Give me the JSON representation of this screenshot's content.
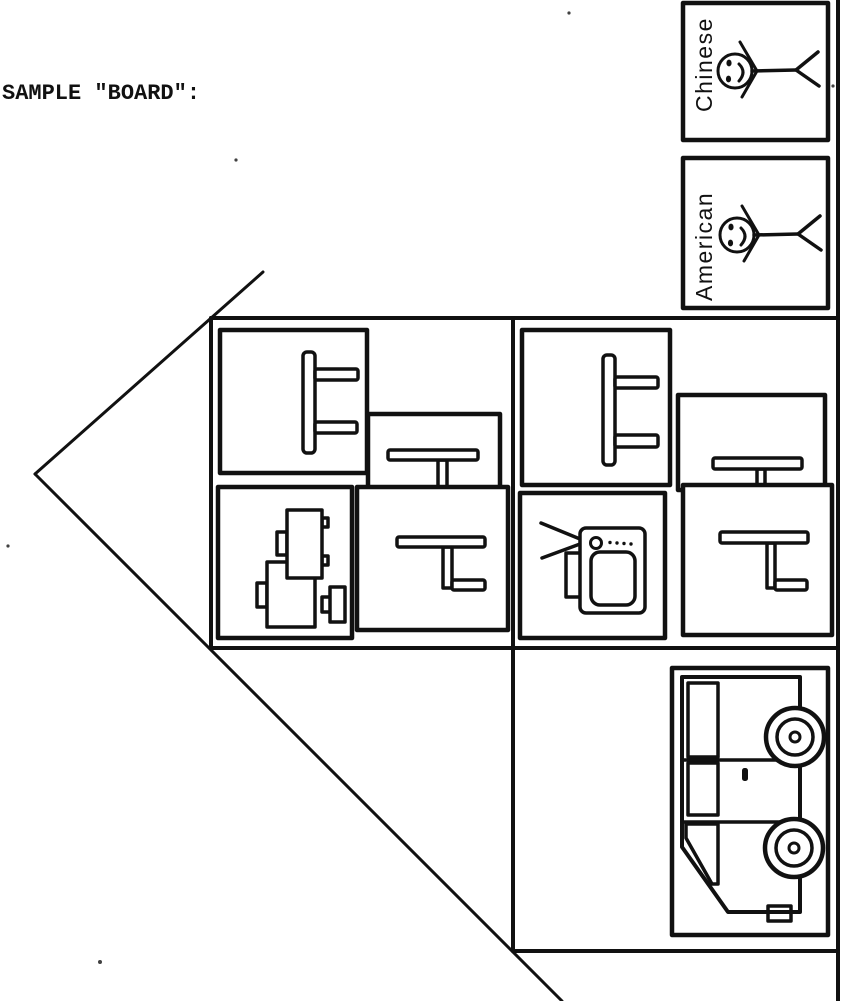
{
  "title": "SAMPLE \"BOARD\":",
  "colors": {
    "ink": "#111111",
    "paper": "#ffffff"
  },
  "players": {
    "cards": [
      {
        "label": "Chinese",
        "icon": "stick-figure-icon"
      },
      {
        "label": "American",
        "icon": "stick-figure-icon"
      }
    ]
  },
  "board": {
    "left_room_cards": [
      "side-table",
      "pedestal-table",
      "cups",
      "table-with-foot"
    ],
    "right_room_cards": [
      "side-table",
      "pedestal-table",
      "table-with-foot",
      "television"
    ],
    "vehicle_card": "bus"
  }
}
